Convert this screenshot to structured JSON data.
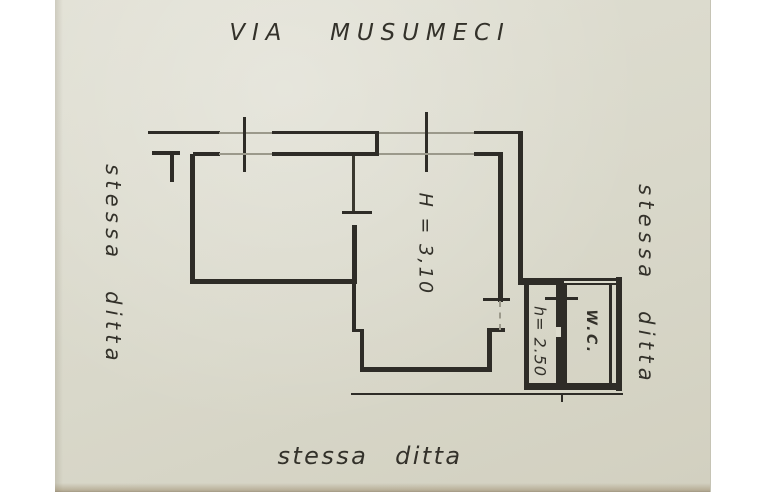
{
  "floor_plan": {
    "street_label": "VIA MUSUMECI",
    "left_boundary_label": "stessa ditta",
    "right_boundary_label": "stessa ditta",
    "bottom_boundary_label": "stessa ditta",
    "rooms": {
      "main_room_height_label": "H = 3,10",
      "corridor_height_label": "h= 2.50",
      "wc_label": "W.C."
    },
    "colors": {
      "page_background": "#ffffff",
      "paper": "#d9d8ca",
      "ink": "#2e2c27",
      "faint_ink": "#9b998b"
    }
  }
}
